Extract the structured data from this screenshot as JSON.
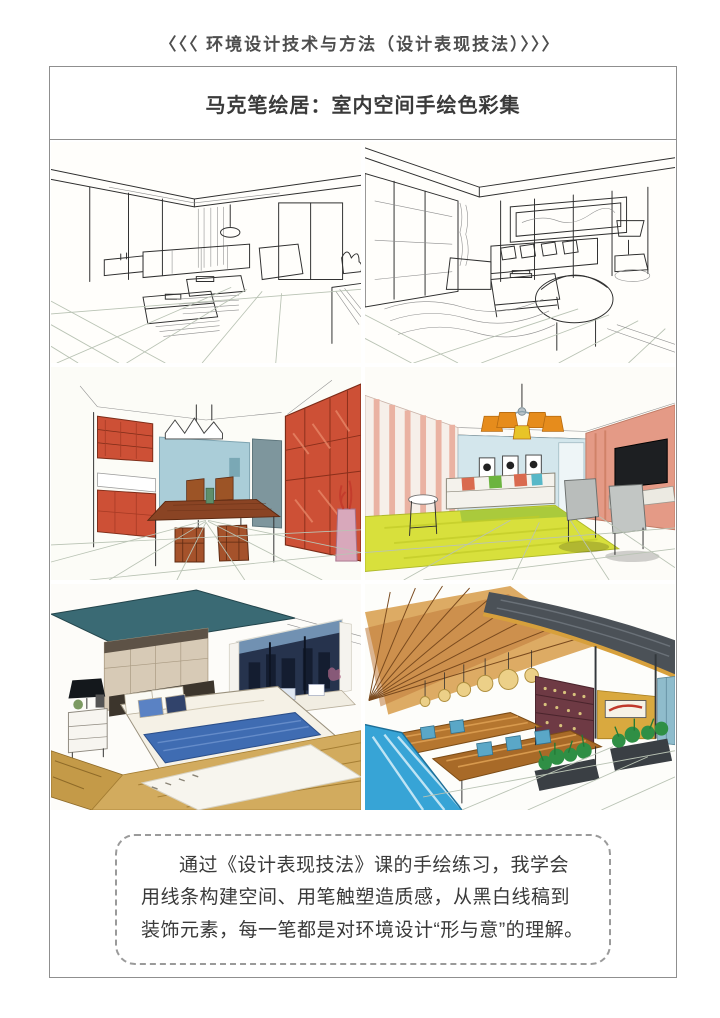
{
  "header": {
    "text": "〈〈〈 环境设计技术与方法（设计表现技法）〉〉〉"
  },
  "title_box": {
    "text": "马克笔绘居：室内空间手绘色彩集"
  },
  "summary_box": {
    "text": "通过《设计表现技法》课的手绘练习，我学会用线条构建空间、用笔触塑造质感，从黑白线稿到装饰元素，每一笔都是对环境设计“形与意”的理解。"
  },
  "gallery": {
    "panels": [
      {
        "label": "bw-line-sketch-living-room-1"
      },
      {
        "label": "bw-line-sketch-living-room-2"
      },
      {
        "label": "marker-rendering-dining-room-red-cabinets"
      },
      {
        "label": "marker-rendering-living-room-chandelier"
      },
      {
        "label": "marker-rendering-bedroom-blue-bedding"
      },
      {
        "label": "marker-rendering-restaurant-wood-ceiling"
      }
    ]
  },
  "colors": {
    "frame_border": "#8f8f8f",
    "heading_text": "#4e4e4e",
    "body_text": "#3a3a3a",
    "cabinet_red": "#cd5036",
    "wall_blue": "#aacdd8",
    "carpet_yellow_green": "#d8e03c",
    "lamp_orange": "#e68c1c",
    "wall_salmon": "#e49a86",
    "bed_blue": "#3f6cb2",
    "floor_wood": "#c79b4a",
    "ceiling_teal": "#3a6a74",
    "restaurant_wood": "#c07a3a",
    "floor_cyan": "#37a4d6",
    "plant_green": "#2f8f45"
  }
}
